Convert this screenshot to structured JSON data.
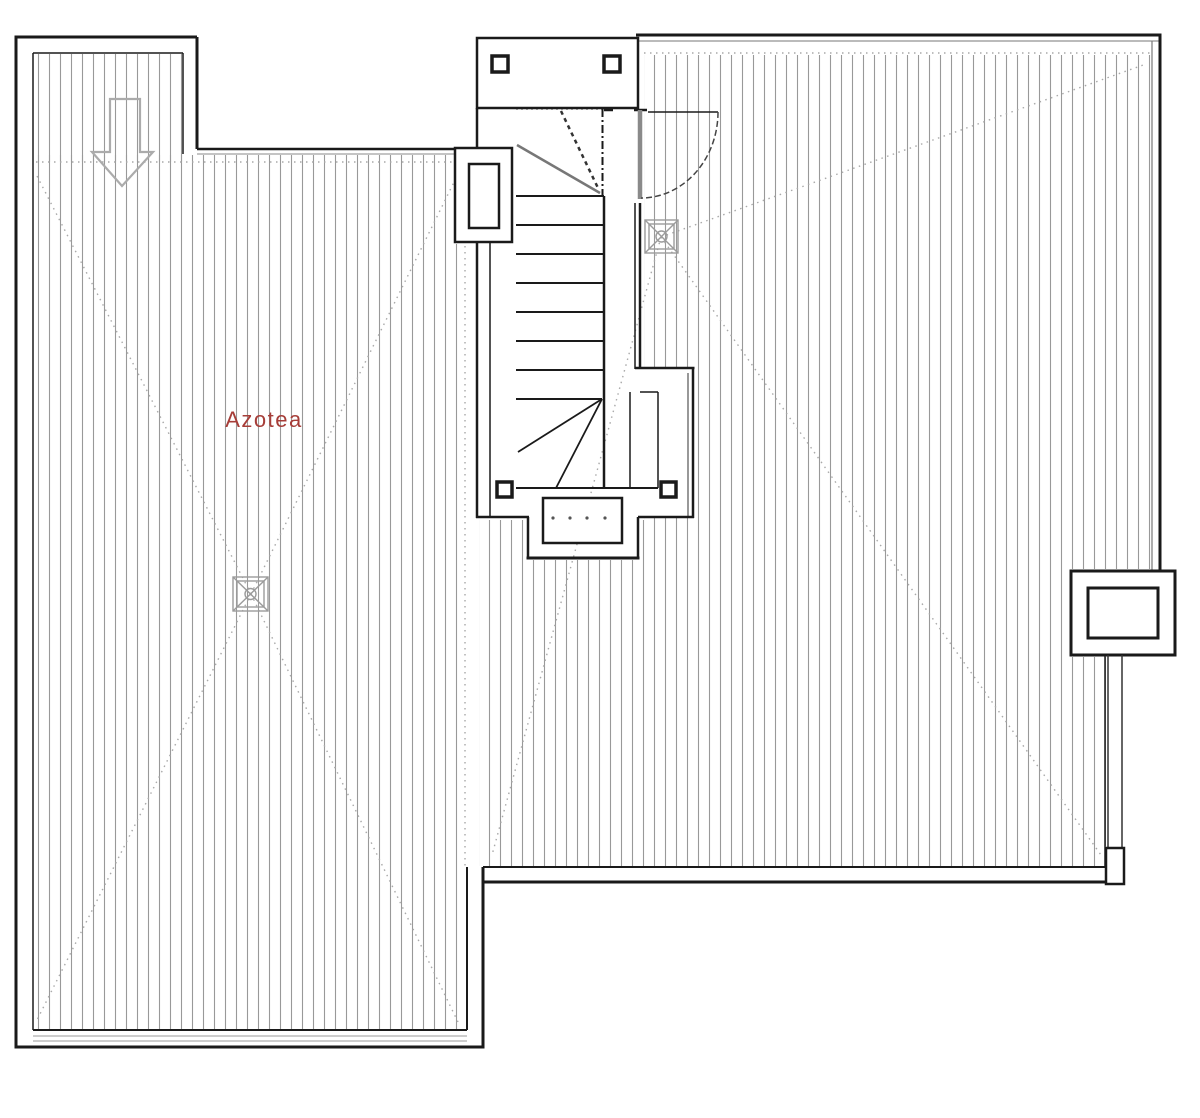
{
  "document": {
    "type": "architectural-roof-floor-plan",
    "floor_name": "Azotea"
  },
  "plan": {
    "room_label": "Azotea",
    "label_color": "#a63d38",
    "colors": {
      "walls": "#1a1a1a",
      "inner_lines": "#555555",
      "hatch": "#999999",
      "dotted_guides": "#a9a9a9",
      "door_leaf": "#8a8a8a",
      "symbols_gray": "#9b9b9b"
    },
    "symbols": {
      "direction_arrow": "down-arrow",
      "roof_drains_count": 2,
      "stair": {
        "straight_treads": 8,
        "upper_winders": true,
        "lower_winders": true,
        "corner_posts": 4
      },
      "door_swing": "quarter-circle",
      "service_box": "roof-equipment-box",
      "drain_pipe": "vertical-downspout"
    }
  }
}
